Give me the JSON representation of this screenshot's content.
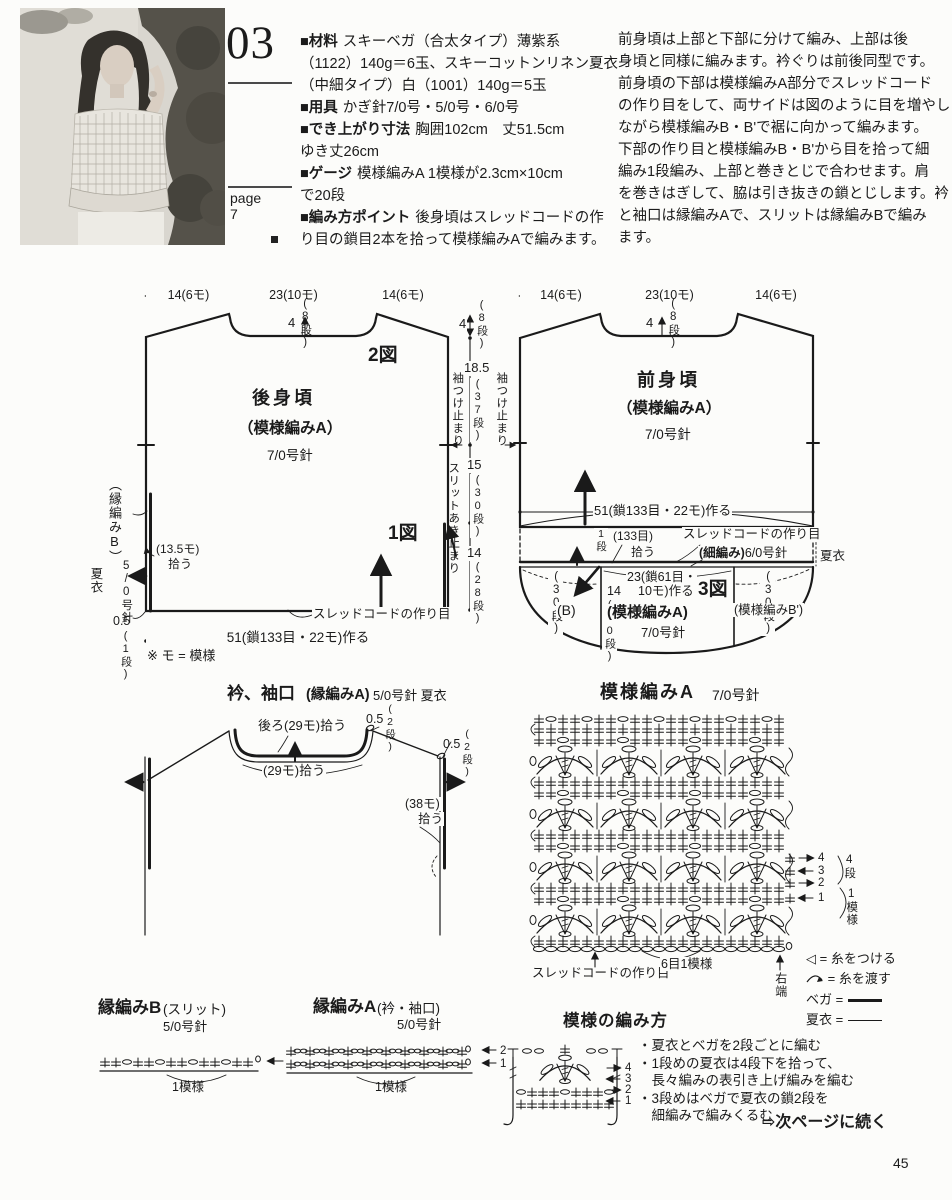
{
  "page": {
    "number": "45"
  },
  "header": {
    "pattern_number": "03",
    "page_label": "page",
    "page_value": "7",
    "materials_lines": [
      {
        "label": "■材料",
        "text": "スキーベガ（合太タイプ）薄紫系"
      },
      {
        "label": "",
        "text": "（1122）140g＝6玉、スキーコットンリネン夏衣"
      },
      {
        "label": "",
        "text": "（中細タイプ）白（1001）140g＝5玉"
      },
      {
        "label": "■用具",
        "text": "かぎ針7/0号・5/0号・6/0号"
      },
      {
        "label": "■でき上がり寸法",
        "text": "胸囲102cm　丈51.5cm"
      },
      {
        "label": "",
        "text": "ゆき丈26cm"
      },
      {
        "label": "■ゲージ",
        "text": "模様編みA 1模様が2.3cm×10cm"
      },
      {
        "label": "",
        "text": "で20段"
      },
      {
        "label": "■編み方ポイント",
        "text": "後身頃はスレッドコードの作"
      },
      {
        "label": "",
        "text": "り目の鎖目2本を拾って模様編みAで編みます。"
      }
    ],
    "intro_lines": [
      "前身頃は上部と下部に分けて編み、上部は後",
      "身頃と同様に編みます。衿ぐりは前後同型です。",
      "前身頃の下部は模様編みA部分でスレッドコード",
      "の作り目をして、両サイドは図のように目を増やし",
      "ながら模様編みB・B'で裾に向かって編みます。",
      "下部の作り目と模様編みB・B'から目を拾って細",
      "編み1段編み、上部と巻きとじで合わせます。肩",
      "を巻きはぎして、脇は引き抜きの鎖とじします。衿",
      "と袖口は縁編みAで、スリットは縁編みBで編み",
      "ます。"
    ]
  },
  "back_piece": {
    "dim_left": "14(6モ)",
    "dim_mid": "23(10モ)",
    "dim_right": "14(6モ)",
    "neck_depth": "4",
    "neck_rows": "(8段)",
    "figure2": "2図",
    "figure1": "1図",
    "name": "後身頃",
    "stitch": "（模様編みA）",
    "hook": "7/0号針",
    "edge_label": "（縁編みB）",
    "edge_hook": "5/0号針",
    "edge_yarn": "夏衣",
    "pickup": "(13.5モ)",
    "pickup2": "拾う",
    "corner": "0.5",
    "corner_rows": "(1段)",
    "note": "※ モ = 模様",
    "cord_note": "スレッドコードの作り目",
    "cast_on": "51(鎖133目・22モ)作る"
  },
  "middle_dims": {
    "d1": "4",
    "d1r": "(8段)",
    "d2": "18.5",
    "d2r": "(37段)",
    "sleeve_stop_left": "袖つけ止まり",
    "sleeve_stop_right": "袖つけ止まり",
    "d3": "15",
    "d3r": "(30段)",
    "slit_stop": "スリットあき止まり",
    "d4": "14",
    "d4r": "(28段)"
  },
  "front_piece": {
    "dim_left": "14(6モ)",
    "dim_mid": "23(10モ)",
    "dim_right": "14(6モ)",
    "neck_depth": "4",
    "neck_rows": "(8段)",
    "name": "前身頃",
    "stitch": "（模様編みA）",
    "hook": "7/0号針",
    "cast_on": "51(鎖133目・22モ)作る",
    "pickup_rows": "1段",
    "pickup_sts": "(133目)",
    "pickup_word": "拾う",
    "cord_note": "スレッドコードの作り目",
    "sc_note": "(細編み)",
    "sc_hook": "6/0号針",
    "yarn": "夏衣",
    "low_left_rows": "(30段)",
    "low_left_label": "(B)",
    "low_mid_h": "14",
    "low_mid_rows": "(30段)",
    "low_mid_cast1": "23(鎖61目・",
    "low_mid_cast2": "10モ)作る",
    "figure3": "3図",
    "low_mid_stitch": "(模様編みA)",
    "low_mid_hook": "7/0号針",
    "low_right_rows": "(30段)",
    "low_right_label": "(模様編みB')"
  },
  "collar": {
    "title": "衿、袖口",
    "title_stitch": "(縁編みA)",
    "title_hook": "5/0号針 夏衣",
    "back_pickup": "後ろ(29モ)拾う",
    "corner1": "0.5",
    "corner1_rows": "(2段)",
    "corner2": "0.5",
    "corner2_rows": "(2段)",
    "neck_pickup": "(29モ)拾う",
    "sleeve_pickup": "(38モ)",
    "sleeve_pickup2": "拾う"
  },
  "pattern_chart": {
    "title": "模様編みA",
    "hook": "7/0号針",
    "row4": "4",
    "row3": "3",
    "row2": "2",
    "row1": "1",
    "rows_label": "4段",
    "repeat_label": "1模様",
    "cord_note": "スレッドコードの作り目",
    "repeat_note": "6目1模様",
    "right_edge": "右端",
    "legend": {
      "attach_icon": "◁",
      "attach": "= 糸をつける",
      "carry": "= 糸を渡す",
      "vega": "ベガ =",
      "natsui": "夏衣 ="
    }
  },
  "edging_b": {
    "title": "縁編みB",
    "subtitle": "(スリット)",
    "hook": "5/0号針",
    "repeat": "1模様"
  },
  "edging_a": {
    "title": "縁編みA",
    "subtitle": "(衿・袖口)",
    "hook": "5/0号針",
    "row2": "2",
    "row1": "1",
    "repeat": "1模様"
  },
  "howto": {
    "title": "模様の編み方",
    "notes": [
      "・夏衣とベガを2段ごとに編む",
      "・1段めの夏衣は4段下を拾って、",
      "　長々編みの表引き上げ編みを編む",
      "・3段めはベガで夏衣の鎖2段を",
      "　細編みで編みくるむ"
    ],
    "row4": "4",
    "row3": "3",
    "row2": "2",
    "row1": "1",
    "continue_icon": "⇨",
    "continue_text": "次ページに続く"
  }
}
